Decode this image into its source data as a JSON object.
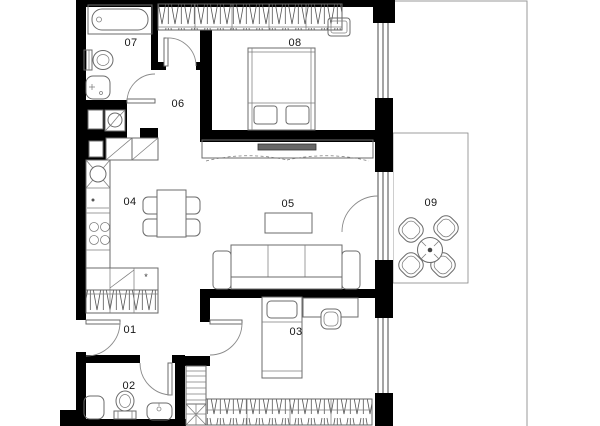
{
  "plan": {
    "rooms": [
      {
        "id": "01",
        "label": "01"
      },
      {
        "id": "02",
        "label": "02"
      },
      {
        "id": "03",
        "label": "03"
      },
      {
        "id": "04",
        "label": "04"
      },
      {
        "id": "05",
        "label": "05"
      },
      {
        "id": "06",
        "label": "06"
      },
      {
        "id": "07",
        "label": "07"
      },
      {
        "id": "08",
        "label": "08"
      },
      {
        "id": "09",
        "label": "09"
      }
    ],
    "symbols": {
      "freezer_star": "*"
    },
    "colors": {
      "wall": "#000000",
      "furniture_line": "#6b6b6b",
      "hatch": "#555555",
      "label": "#161616",
      "tv_screen": "#666666",
      "boundary": "#9a9a9a",
      "background": "#ffffff"
    }
  }
}
